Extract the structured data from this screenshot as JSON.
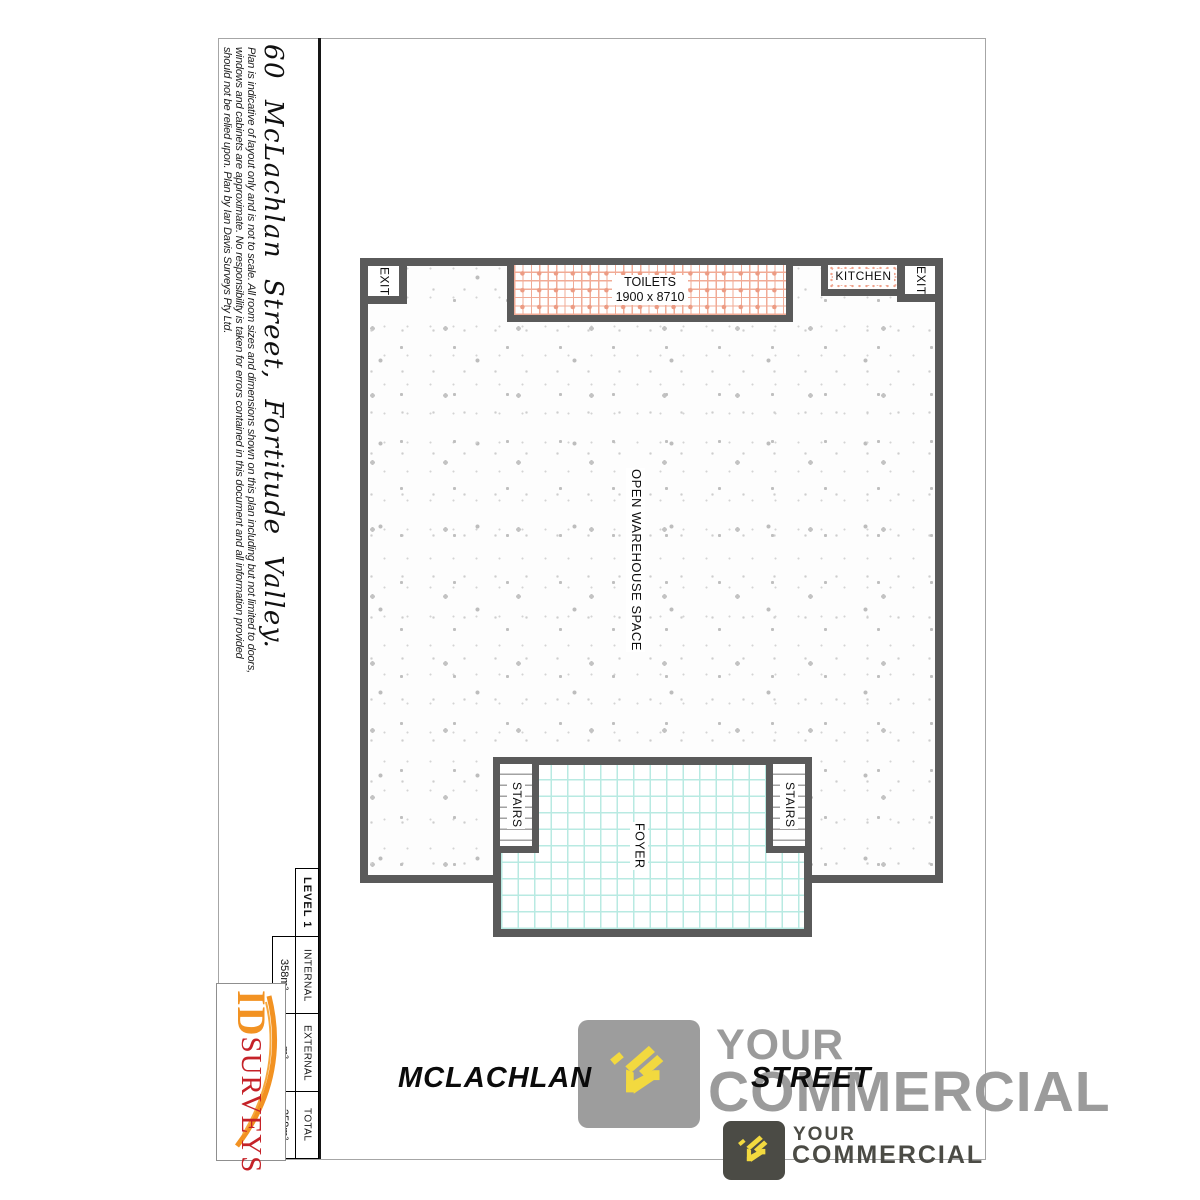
{
  "document": {
    "title": "60 McLachlan Street, Fortitude Valley.",
    "disclaimer": {
      "line1": "Plan is indicative of layout only and is not to scale. All room sizes and dimensions shown on this plan including but not limited to doors,",
      "line2": "windows and cabinets are approximate. No responsibility is taken for errors contained in this document and all information provided",
      "line3": "should not be relied upon. Plan by Ian Davis Surveys Pty Ltd."
    }
  },
  "floor_plan": {
    "exit_top_left": "EXIT",
    "toilets_label": "TOILETS",
    "toilets_dimensions": "1900 x 8710",
    "kitchen_label": "KITCHEN",
    "exit_top_right": "EXIT",
    "warehouse_label": "OPEN WAREHOUSE SPACE",
    "stairs_left_label": "STAIRS",
    "stairs_right_label": "STAIRS",
    "foyer_label": "FOYER"
  },
  "area_table": {
    "level": "LEVEL 1",
    "rows": [
      {
        "label": "INTERNAL",
        "value": "358m²"
      },
      {
        "label": "EXTERNAL",
        "value": "m²"
      },
      {
        "label": "TOTAL",
        "value": "358m²"
      }
    ]
  },
  "surveyor": {
    "name_part1": "ID",
    "name_part2": "SURVEYS"
  },
  "street_banner": {
    "word1": "MCLACHLAN",
    "word2": "STREET"
  },
  "watermark": {
    "line1": "YOUR",
    "line2": "COMMERCIAL"
  },
  "footer_logo": {
    "line1": "YOUR",
    "line2": "COMMERCIAL"
  },
  "colors": {
    "wall": "#5a5a5a",
    "toilet_grid": "#f1ab96",
    "kitchen_stipple": "#efa28c",
    "foyer_tile": "#b8eae2",
    "watermark_gray": "#9b9b9b",
    "logo_dark": "#4b4b45",
    "logo_yellow": "#f2d93f",
    "surveyor_orange": "#f29222",
    "surveyor_red": "#c52228"
  }
}
